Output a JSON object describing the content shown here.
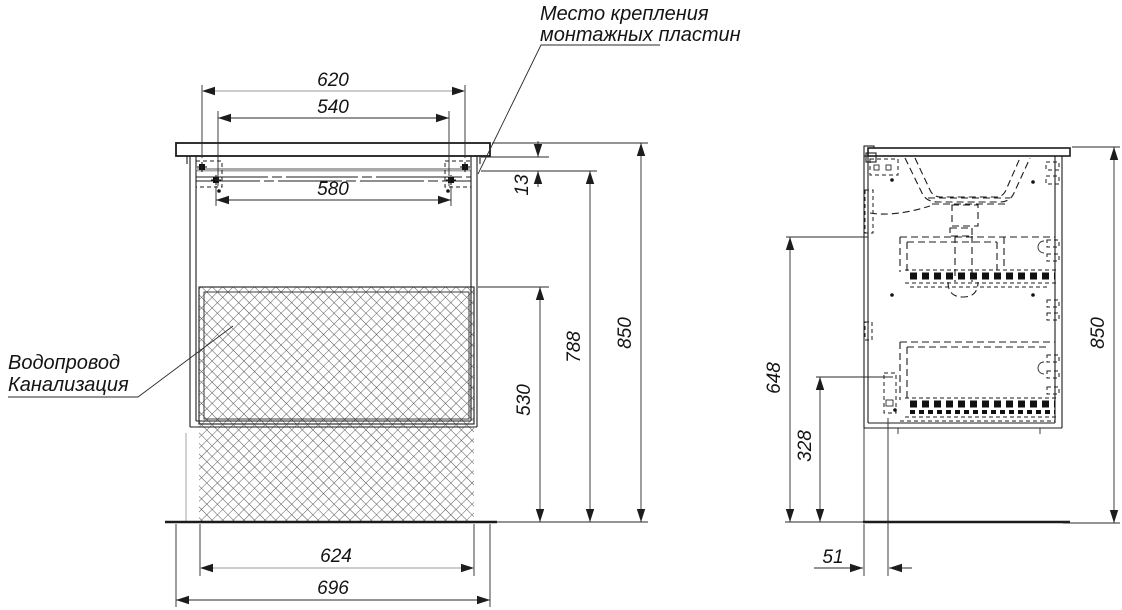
{
  "colors": {
    "ink": "#1c1c1c",
    "gray_line": "#9a9a9a",
    "background": "#ffffff"
  },
  "notes": {
    "mounting_plates": {
      "line1": "Место крепления",
      "line2": "монтажных пластин"
    },
    "plumbing": {
      "line1": "Водопровод",
      "line2": "Канализация"
    }
  },
  "front_view": {
    "dims": {
      "mount_holes_outer": "620",
      "mount_holes_inner": "540",
      "mount_rail": "580",
      "top_offset": "13",
      "rail_height": "788",
      "overall_height": "850",
      "opening_height": "530",
      "opening_width": "624",
      "overall_width": "696"
    }
  },
  "side_view": {
    "dims": {
      "upper_bracket_height": "648",
      "lower_bracket_height": "328",
      "overall_height": "850",
      "back_offset": "51"
    }
  }
}
